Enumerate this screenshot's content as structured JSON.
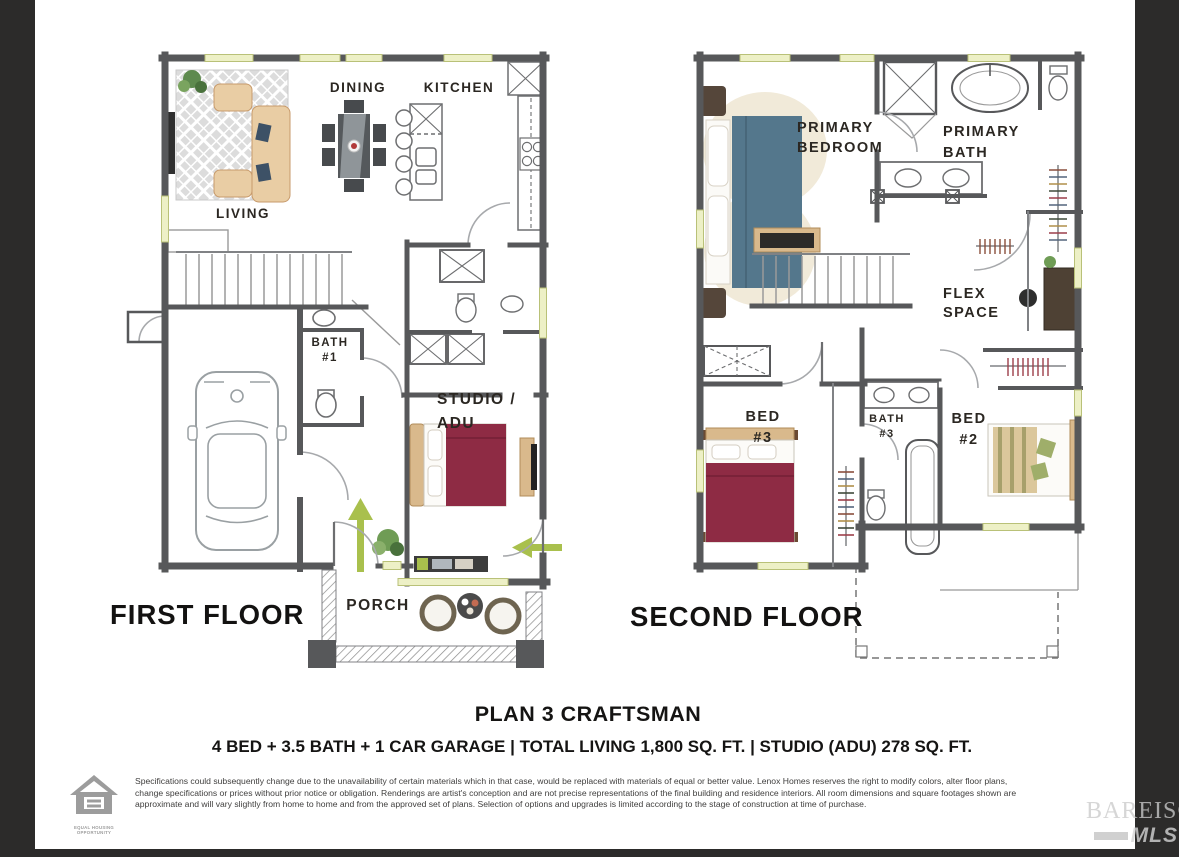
{
  "page": {
    "background": "#2c2b2a",
    "paper": "#ffffff"
  },
  "first_floor": {
    "title": "FIRST FLOOR",
    "rooms": {
      "living": "LIVING",
      "dining": "DINING",
      "kitchen": "KITCHEN",
      "bath1_l1": "BATH",
      "bath1_l2": "#1",
      "studio_l1": "STUDIO /",
      "studio_l2": "ADU",
      "porch": "PORCH"
    }
  },
  "second_floor": {
    "title": "SECOND FLOOR",
    "rooms": {
      "primary_bedroom_l1": "PRIMARY",
      "primary_bedroom_l2": "BEDROOM",
      "primary_bath_l1": "PRIMARY",
      "primary_bath_l2": "BATH",
      "flex_l1": "FLEX",
      "flex_l2": "SPACE",
      "bed3_l1": "BED",
      "bed3_l2": "#3",
      "bath3_l1": "BATH",
      "bath3_l2": "#3",
      "bed2_l1": "BED",
      "bed2_l2": "#2"
    }
  },
  "title_block": {
    "plan_title": "PLAN 3 CRAFTSMAN",
    "plan_specs": "4 BED + 3.5 BATH + 1 CAR GARAGE | TOTAL LIVING 1,800 SQ. FT. | STUDIO (ADU) 278 SQ. FT.",
    "disclaimer": "Specifications could subsequently change due to the unavailability of certain materials which in that case, would be replaced with materials of equal or better value. Lenox Homes reserves the right to modify colors, alter floor plans, change specifications or prices without prior notice or obligation. Renderings are artist's conception and are not precise representations of the final building and residence interiors. All room dimensions and square footages shown are approximate and will vary slightly from home to home and from the approved set of plans. Selection of options and upgrades is limited according to the stage of construction at time of purchase."
  },
  "footer": {
    "equal_housing_label": "EQUAL HOUSING OPPORTUNITY",
    "watermark_line1": "BAREIS®",
    "watermark_line2": "MLS"
  },
  "colors": {
    "wall": "#57585a",
    "window": "#edf0c6",
    "accent_green": "#a9c04d",
    "bed_teal": "#54778c",
    "bed_maroon": "#8e2b44",
    "furniture_tan": "#e9cda4"
  }
}
